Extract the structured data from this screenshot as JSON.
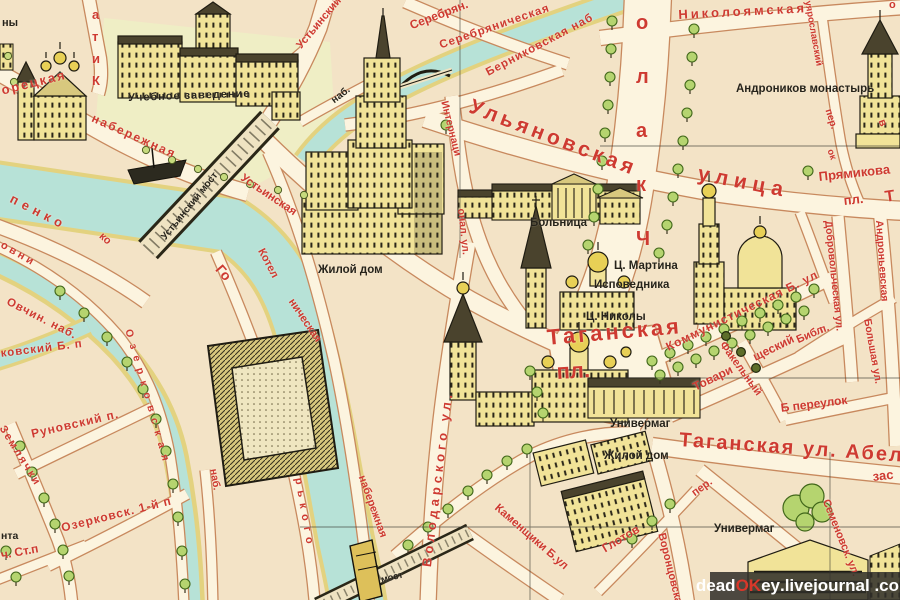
{
  "map": {
    "region": "Taganka district pictorial map (Moscow)",
    "palette": {
      "paper": "#f3e3c6",
      "street": "#fcf4df",
      "street_outline": "#c8895e",
      "water": "#b7e2d7",
      "embankment": "#e3d27f",
      "building": "#f1e398",
      "ink": "#201d12",
      "label_red": "#ce3a31",
      "label_black": "#26231a",
      "tree": "#b5d46f",
      "tree_stroke": "#41671a"
    },
    "labels": [
      {
        "n": "frag-ny",
        "t": "ны",
        "x": 2,
        "y": 18,
        "r": 0,
        "s": 11,
        "c": "black"
      },
      {
        "n": "uchebnoe-zavedenie",
        "t": "Учебное заведение",
        "x": 128,
        "y": 93,
        "r": -2,
        "s": 11,
        "c": "black",
        "ls": 1
      },
      {
        "n": "moskvoretskaya-frag",
        "t": "орецкая",
        "x": 0,
        "y": 84,
        "r": -14,
        "s": 13,
        "c": "red",
        "ls": 2
      },
      {
        "n": "naberezhnaya-nw",
        "t": "набережная",
        "x": 95,
        "y": 112,
        "r": 24,
        "s": 12,
        "c": "red",
        "ls": 2
      },
      {
        "n": "kitaysky-pr",
        "t": "а\nт\nи\nК",
        "x": 92,
        "y": 4,
        "r": 0,
        "s": 13,
        "c": "red",
        "lh": 22
      },
      {
        "n": "ustinsky-pr",
        "t": "Устьинский пр.",
        "x": 295,
        "y": 44,
        "r": -50,
        "s": 11,
        "c": "red"
      },
      {
        "n": "serebryan",
        "t": "Серебрян.",
        "x": 408,
        "y": 20,
        "r": -21,
        "s": 12,
        "c": "red"
      },
      {
        "n": "serebryanicheskaya",
        "t": "Серебряническая",
        "x": 438,
        "y": 40,
        "r": -19,
        "s": 11.5,
        "c": "red",
        "ls": 1
      },
      {
        "n": "bernikovskaya-nab",
        "t": "Берниковская наб",
        "x": 484,
        "y": 68,
        "r": -28,
        "s": 11.5,
        "c": "red",
        "ls": 1
      },
      {
        "n": "nab-frag-yauza",
        "t": "наб.",
        "x": 330,
        "y": 98,
        "r": -38,
        "s": 10,
        "c": "black"
      },
      {
        "n": "nikoloyamskaya",
        "t": "Николоямская",
        "x": 678,
        "y": 8,
        "r": -3,
        "s": 13,
        "c": "red",
        "ls": 3
      },
      {
        "n": "poluyaroslavsky",
        "t": "уярославский",
        "x": 812,
        "y": 0,
        "r": 80,
        "s": 9.5,
        "c": "red"
      },
      {
        "n": "poluyaroslavsky-per",
        "t": "пер.",
        "x": 832,
        "y": 108,
        "r": 72,
        "s": 10,
        "c": "red"
      },
      {
        "n": "andronikov-monastyr",
        "t": "Андроников монастырь",
        "x": 736,
        "y": 83,
        "r": 0,
        "s": 11.5,
        "c": "black"
      },
      {
        "n": "ulyanovskaya",
        "t": "Ульяновская",
        "x": 474,
        "y": 96,
        "r": 21,
        "s": 21,
        "c": "red",
        "ls": 4
      },
      {
        "n": "ulitsa",
        "t": "улица",
        "x": 700,
        "y": 163,
        "r": 11,
        "s": 21,
        "c": "red",
        "ls": 6
      },
      {
        "n": "internatsionalnaya-1",
        "t": "Интернаци",
        "x": 449,
        "y": 100,
        "r": 76,
        "s": 10.5,
        "c": "red"
      },
      {
        "n": "internatsionalnaya-2",
        "t": "онал. ул.",
        "x": 466,
        "y": 208,
        "r": 84,
        "s": 10.5,
        "c": "red"
      },
      {
        "n": "chkalova",
        "t": "о\nл\nа\nк\nЧ",
        "x": 636,
        "y": -4,
        "r": 0,
        "s": 20,
        "c": "red",
        "lh": 54
      },
      {
        "n": "pryamikova",
        "t": "Прямикова",
        "x": 818,
        "y": 170,
        "r": -6,
        "s": 13,
        "c": "red"
      },
      {
        "n": "pryamikova-pl",
        "t": "пл.",
        "x": 843,
        "y": 194,
        "r": -6,
        "s": 13,
        "c": "red"
      },
      {
        "n": "frag-t",
        "t": "Т",
        "x": 884,
        "y": 190,
        "r": -8,
        "s": 16,
        "c": "red"
      },
      {
        "n": "ts-martina-1",
        "t": "Ц. Мартина",
        "x": 614,
        "y": 260,
        "r": 0,
        "s": 11.5,
        "c": "black"
      },
      {
        "n": "ts-martina-2",
        "t": "Исповедника",
        "x": 594,
        "y": 279,
        "r": 0,
        "s": 11.5,
        "c": "black"
      },
      {
        "n": "bolnitsa",
        "t": "Больница",
        "x": 530,
        "y": 217,
        "r": 0,
        "s": 11.5,
        "c": "black"
      },
      {
        "n": "zhiloy-dom-1",
        "t": "Жилой дом",
        "x": 318,
        "y": 264,
        "r": 0,
        "s": 11.5,
        "c": "black"
      },
      {
        "n": "ts-nikoly",
        "t": "Ц. Николы",
        "x": 586,
        "y": 311,
        "r": 0,
        "s": 11.5,
        "c": "black"
      },
      {
        "n": "dobrovolcheskaya",
        "t": "Добровольческая ул.",
        "x": 833,
        "y": 220,
        "r": 84,
        "s": 10.5,
        "c": "red"
      },
      {
        "n": "andronyevskaya",
        "t": "Андроньевская",
        "x": 884,
        "y": 220,
        "r": 86,
        "s": 10.5,
        "c": "red"
      },
      {
        "n": "bolshaya-ul",
        "t": "Большая ул.",
        "x": 872,
        "y": 318,
        "r": 80,
        "s": 10.5,
        "c": "red"
      },
      {
        "n": "kommunisticheskaya",
        "t": "Коммунистическая Б. ул",
        "x": 664,
        "y": 342,
        "r": -26,
        "s": 12,
        "c": "red",
        "ls": 1
      },
      {
        "n": "taganskaya-pl-1",
        "t": "Таганская",
        "x": 546,
        "y": 326,
        "r": -5,
        "s": 22,
        "c": "red",
        "ls": 3
      },
      {
        "n": "taganskaya-pl-2",
        "t": "пл.",
        "x": 556,
        "y": 360,
        "r": -3,
        "s": 22,
        "c": "red"
      },
      {
        "n": "tovarishchesky-1",
        "t": "Товари",
        "x": 691,
        "y": 382,
        "r": -26,
        "s": 12,
        "c": "red"
      },
      {
        "n": "tovarishchesky-2",
        "t": "щеский",
        "x": 751,
        "y": 352,
        "r": -26,
        "s": 12,
        "c": "red"
      },
      {
        "n": "tovarishchesky-p",
        "t": "п.",
        "x": 818,
        "y": 326,
        "r": -20,
        "s": 11,
        "c": "red"
      },
      {
        "n": "fakelny",
        "t": "Факельный",
        "x": 726,
        "y": 340,
        "r": 54,
        "s": 11,
        "c": "red"
      },
      {
        "n": "b-pereulok",
        "t": "Б переулок",
        "x": 780,
        "y": 402,
        "r": -7,
        "s": 12,
        "c": "red"
      },
      {
        "n": "bibliotechnaya-frag",
        "t": "Библ",
        "x": 795,
        "y": 336,
        "r": -24,
        "s": 11,
        "c": "red"
      },
      {
        "n": "univermag-1",
        "t": "Универмаг",
        "x": 610,
        "y": 418,
        "r": 0,
        "s": 11.5,
        "c": "black"
      },
      {
        "n": "taganskaya-ul",
        "t": "Таганская ул. Абел",
        "x": 680,
        "y": 430,
        "r": 4,
        "s": 20,
        "c": "red",
        "ls": 2
      },
      {
        "n": "zastava-frag",
        "t": "зас",
        "x": 872,
        "y": 470,
        "r": -6,
        "s": 13,
        "c": "red"
      },
      {
        "n": "zhiloy-dom-2",
        "t": "Жилой дом",
        "x": 604,
        "y": 450,
        "r": 0,
        "s": 11.5,
        "c": "black"
      },
      {
        "n": "per-frag",
        "t": "пер.",
        "x": 690,
        "y": 490,
        "r": -36,
        "s": 11,
        "c": "red"
      },
      {
        "n": "glotov",
        "t": "Глотов",
        "x": 600,
        "y": 544,
        "r": -31,
        "s": 12,
        "c": "red"
      },
      {
        "n": "vorontsovskaya",
        "t": "Воронцовская",
        "x": 666,
        "y": 532,
        "r": 76,
        "s": 11,
        "c": "red"
      },
      {
        "n": "semenovskaya",
        "t": "Семеновск. ул.",
        "x": 830,
        "y": 498,
        "r": 68,
        "s": 11,
        "c": "red"
      },
      {
        "n": "univermag-2",
        "t": "Универмаг",
        "x": 714,
        "y": 523,
        "r": 0,
        "s": 11.5,
        "c": "black"
      },
      {
        "n": "kamenshchiki",
        "t": "Каменщики Б.ул",
        "x": 500,
        "y": 502,
        "r": 41,
        "s": 11.5,
        "c": "red"
      },
      {
        "n": "most-frag",
        "t": "мост",
        "x": 380,
        "y": 576,
        "r": -14,
        "s": 9.5,
        "c": "black"
      },
      {
        "n": "naberezhnaya-e",
        "t": "набережная",
        "x": 366,
        "y": 474,
        "r": 70,
        "s": 11,
        "c": "red"
      },
      {
        "n": "volodarskogo",
        "t": "Володарского ул.",
        "x": 420,
        "y": 566,
        "r": -83,
        "s": 13,
        "c": "red",
        "ls": 4
      },
      {
        "n": "ozerkovskaya",
        "t": "Озерковская",
        "x": 133,
        "y": 328,
        "r": 74,
        "s": 10.5,
        "c": "red",
        "ls": 7
      },
      {
        "n": "nab-kanal",
        "t": "наб.",
        "x": 218,
        "y": 468,
        "r": 80,
        "s": 10.5,
        "c": "red"
      },
      {
        "n": "ovchin-nab",
        "t": "Овчин. наб.",
        "x": 10,
        "y": 296,
        "r": 27,
        "s": 11.5,
        "c": "red",
        "ls": 1
      },
      {
        "n": "kovsky-b-p",
        "t": "ковский Б. п",
        "x": 0,
        "y": 348,
        "r": -7,
        "s": 11.5,
        "c": "red",
        "ls": 1
      },
      {
        "n": "runovsky",
        "t": "Руновский п.",
        "x": 30,
        "y": 428,
        "r": -13,
        "s": 12,
        "c": "red",
        "ls": 1
      },
      {
        "n": "ozerkovsk-1",
        "t": "Озерковск. 1-й п",
        "x": 60,
        "y": 522,
        "r": -14,
        "s": 12,
        "c": "red",
        "ls": 1
      },
      {
        "n": "st-p",
        "t": "ч. Ст.п",
        "x": 0,
        "y": 549,
        "r": -10,
        "s": 12,
        "c": "red"
      },
      {
        "n": "frag-nta",
        "t": "нта",
        "x": 1,
        "y": 531,
        "r": 0,
        "s": 10.5,
        "c": "black"
      },
      {
        "n": "zemlyachki",
        "t": "Землячки",
        "x": 6,
        "y": 424,
        "r": 58,
        "s": 11,
        "c": "red",
        "ls": 2
      },
      {
        "n": "osipenko-frag",
        "t": "пенко",
        "x": 14,
        "y": 192,
        "r": 27,
        "s": 13,
        "c": "red",
        "ls": 5
      },
      {
        "n": "ovni-frag",
        "t": "овни",
        "x": 4,
        "y": 240,
        "r": 30,
        "s": 11,
        "c": "red",
        "ls": 3
      },
      {
        "n": "ko-frag",
        "t": "ко",
        "x": 104,
        "y": 231,
        "r": 42,
        "s": 11,
        "c": "red"
      },
      {
        "n": "ustinsky-most",
        "t": "Устьинский мост",
        "x": 160,
        "y": 236,
        "r": -51,
        "s": 10,
        "c": "black"
      },
      {
        "n": "ustinskaya",
        "t": "Устьинская",
        "x": 245,
        "y": 172,
        "r": 34,
        "s": 11.5,
        "c": "red"
      },
      {
        "n": "kotelnicheskaya-1",
        "t": "Котел",
        "x": 265,
        "y": 247,
        "r": 62,
        "s": 11,
        "c": "red"
      },
      {
        "n": "kotelnicheskaya-2",
        "t": "ническая",
        "x": 295,
        "y": 297,
        "r": 56,
        "s": 11,
        "c": "red"
      },
      {
        "n": "gorkogo-1",
        "t": "Го",
        "x": 224,
        "y": 262,
        "r": 50,
        "s": 14,
        "c": "red"
      },
      {
        "n": "gorkogo-2",
        "t": "рького",
        "x": 303,
        "y": 477,
        "r": 80,
        "s": 11,
        "c": "red",
        "ls": 6
      },
      {
        "n": "frag-o",
        "t": "о",
        "x": 889,
        "y": 0,
        "r": 0,
        "s": 11,
        "c": "red"
      },
      {
        "n": "frag-v",
        "t": "в",
        "x": 886,
        "y": 118,
        "r": 70,
        "s": 11,
        "c": "red"
      },
      {
        "n": "frag-ok",
        "t": "ок",
        "x": 834,
        "y": 148,
        "r": 70,
        "s": 9.5,
        "c": "red"
      }
    ],
    "watermark": {
      "parts": [
        {
          "t": "dead",
          "c": "#ffffff"
        },
        {
          "t": "OK",
          "c": "#d8372a"
        },
        {
          "t": "ey",
          "c": "#ffffff"
        },
        {
          "t": ".livejournal",
          "c": "#ffffff"
        },
        {
          "t": " .com",
          "c": "#ffffff"
        }
      ]
    }
  }
}
